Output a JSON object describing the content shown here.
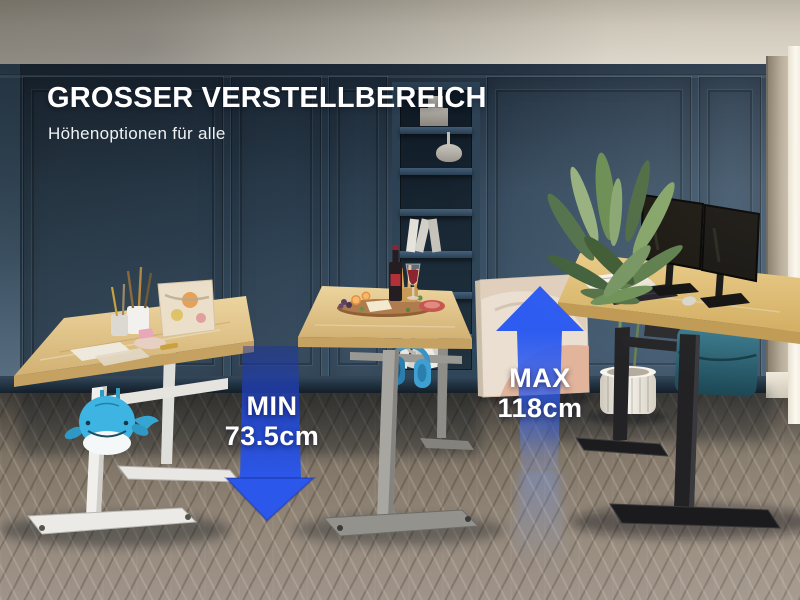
{
  "scene": {
    "title": "GROSSER VERSTELLBEREICH",
    "subtitle": "Höhenoptionen für alle",
    "annotations": {
      "min": {
        "label": "MIN",
        "value": "73.5cm",
        "icon": "arrow-down-icon"
      },
      "max": {
        "label": "MAX",
        "value": "118cm",
        "icon": "arrow-up-icon"
      }
    },
    "desks": [
      {
        "id": "desk-lowest",
        "frame": "white",
        "frame_hex": "#ECEAE5",
        "position": "left"
      },
      {
        "id": "desk-middle",
        "frame": "grey",
        "frame_hex": "#9F9D99",
        "position": "center"
      },
      {
        "id": "desk-highest",
        "frame": "black",
        "frame_hex": "#1E1E20",
        "position": "right"
      }
    ],
    "colors": {
      "accent_blue": "#2553E6",
      "wall_blue": "#33485B",
      "ceiling_beige": "#CDC6B8",
      "floor_grey_brown": "#8B8073",
      "desktop_wood": "#DDBF85",
      "text_white": "#FFFFFF"
    }
  }
}
